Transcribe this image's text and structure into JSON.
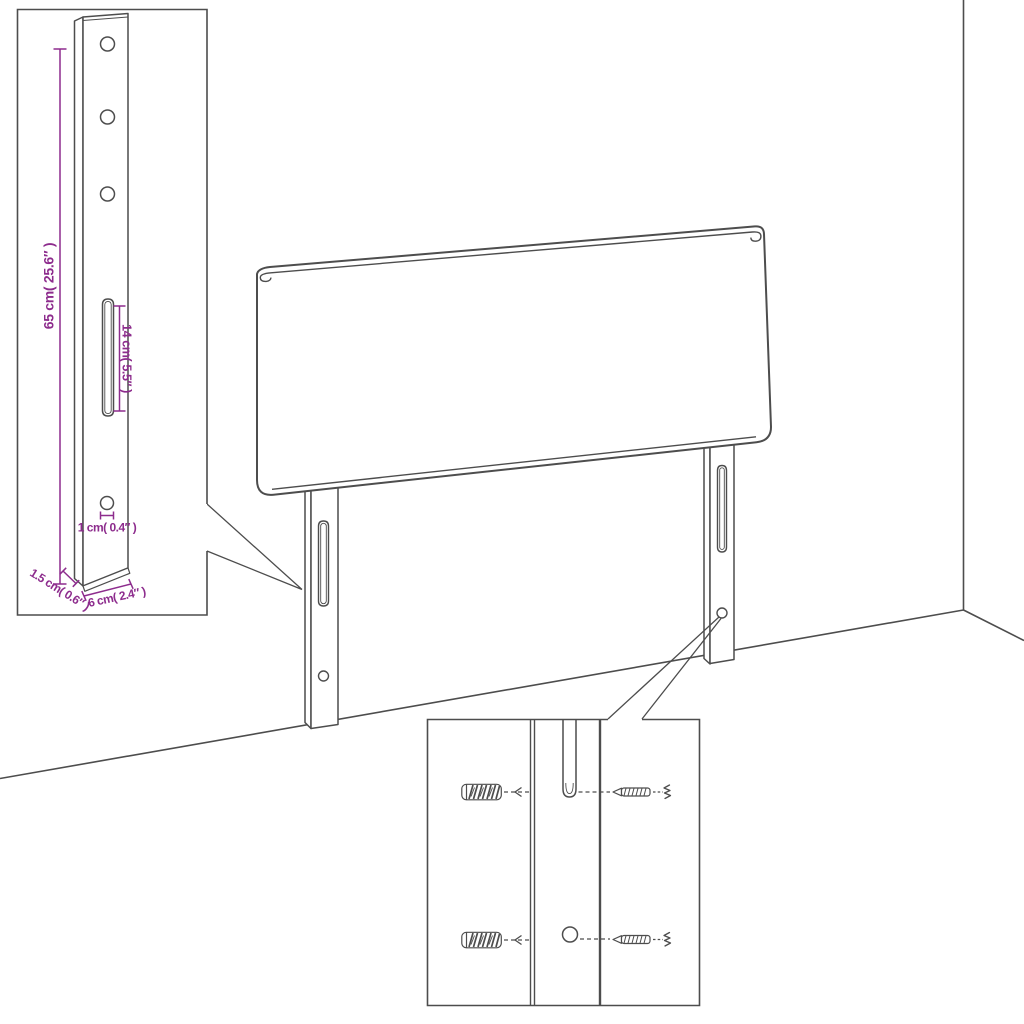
{
  "figure": {
    "kind": "furniture dimension diagram",
    "subject": "headboard with two mounting legs, room corner backdrop, two detail insets",
    "colors": {
      "background": "#ffffff",
      "outline": "#4d4d4d",
      "dimension": "#8d2c8d"
    }
  },
  "leg_detail_inset": {
    "labels": {
      "height": "65 cm( 25.6″ )",
      "slot": "14 cm( 5.5″ )",
      "hole": "1 cm( 0.4″ )",
      "thickness": "1.5 cm( 0.6″ )",
      "width": "6 cm( 2.4″ )"
    }
  },
  "hardware_detail_inset": {
    "parts": [
      "wall plug",
      "screw"
    ]
  }
}
